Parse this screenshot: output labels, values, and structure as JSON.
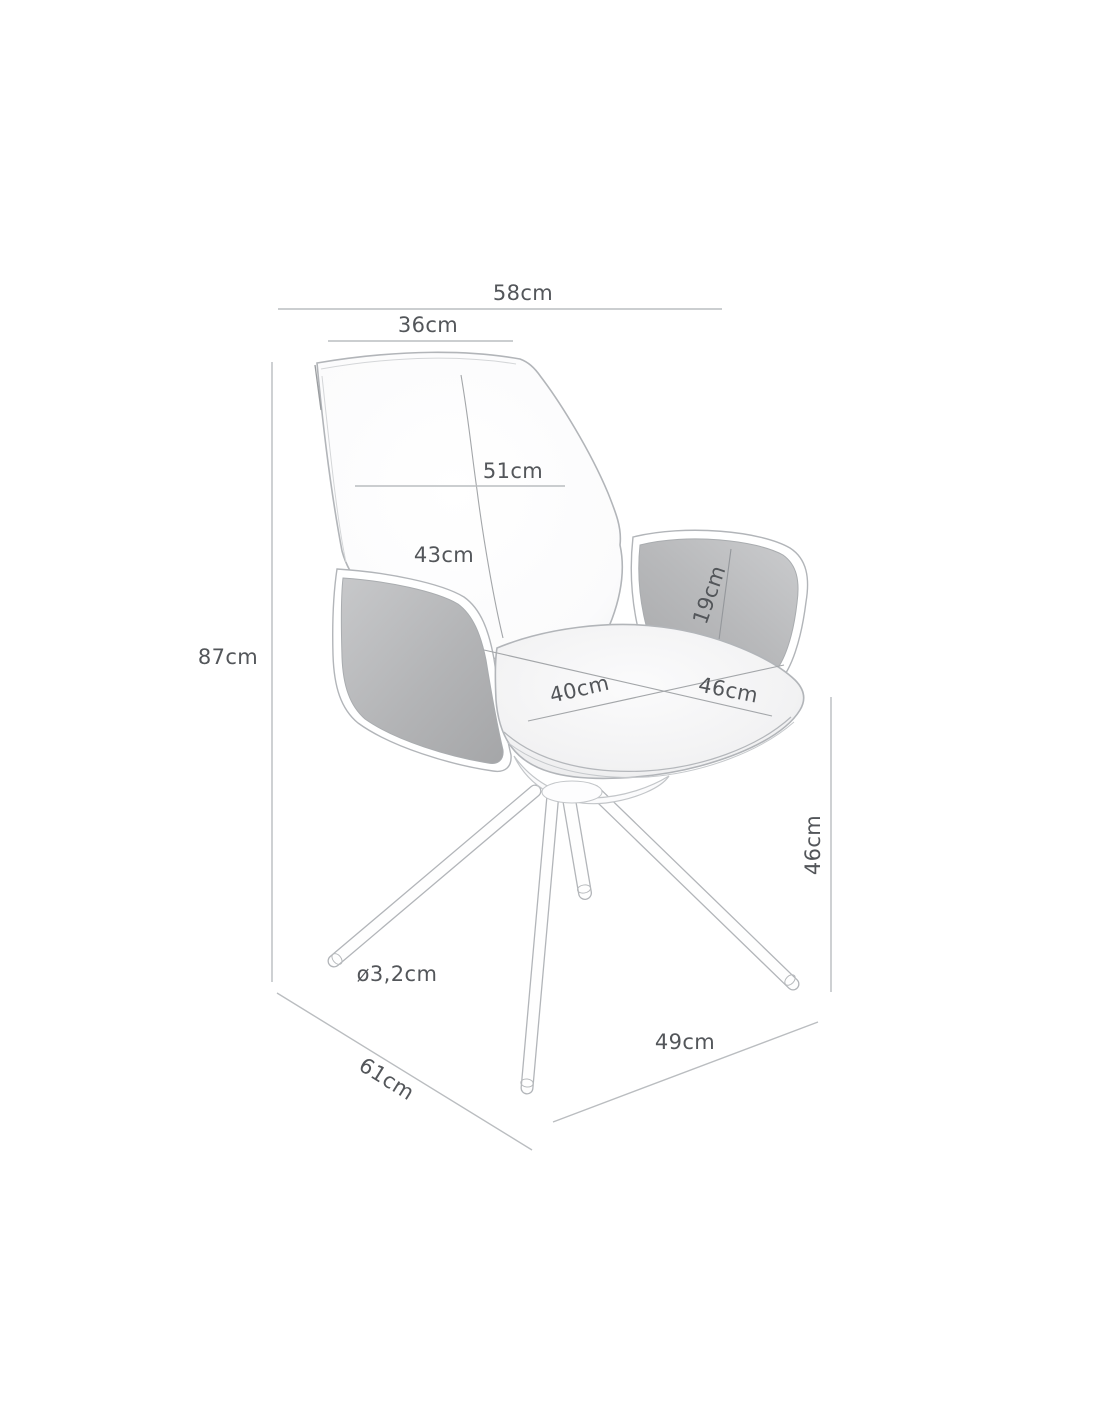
{
  "diagram": {
    "kind": "product-dimension-diagram",
    "subject": "swivel armchair with armrests, upholstered shell and four splayed legs",
    "unit": "cm",
    "labels": {
      "total_width": "58cm",
      "back_top_width": "36cm",
      "backrest_width": "51cm",
      "backrest_height": "43cm",
      "armrest_height": "19cm",
      "total_height": "87cm",
      "seat_width": "40cm",
      "seat_depth": "46cm",
      "seat_height": "46cm",
      "leg_diameter": "ø3,2cm",
      "base_depth": "49cm",
      "total_depth": "61cm"
    },
    "colors": {
      "background": "#ffffff",
      "dimension_line": "#babdc0",
      "text": "#53565a",
      "chair_outline": "#b2b5b9",
      "upholstery_gray": "#b3b4b6",
      "shell_white": "#fcfcfd"
    }
  }
}
